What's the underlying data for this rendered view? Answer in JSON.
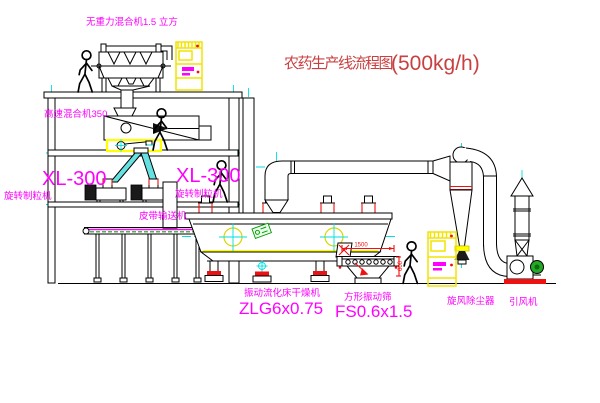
{
  "title": {
    "text": "农药生产线流程图",
    "capacity": "(500kg/h)"
  },
  "labels": {
    "gravity_mixer": "无重力混合机1.5 立方",
    "high_speed_mixer": "高速混合机350",
    "granulator_left": {
      "model": "XL-300",
      "name": "旋转制粒机"
    },
    "granulator_right": {
      "model": "XL-300",
      "name": "旋转制粒机"
    },
    "belt_conveyor": "皮带输送机",
    "dryer": {
      "name": "振动流化床干燥机",
      "model": "ZLG6x0.75"
    },
    "sieve": {
      "name": "方形振动筛",
      "model": "FS0.6x1.5"
    },
    "cyclone": "旋风除尘器",
    "fan": "引风机"
  },
  "dimensions": {
    "sieve_length": "1500",
    "sieve_width": "600"
  },
  "colors": {
    "label": "#ff00ff",
    "title": "#c94040",
    "dimension": "#ee1111",
    "centerline": "#00dede",
    "highlight": "#ffff00",
    "belt": "#00aa00",
    "motor": "#22aa22",
    "base_pad": "#ee1111"
  }
}
